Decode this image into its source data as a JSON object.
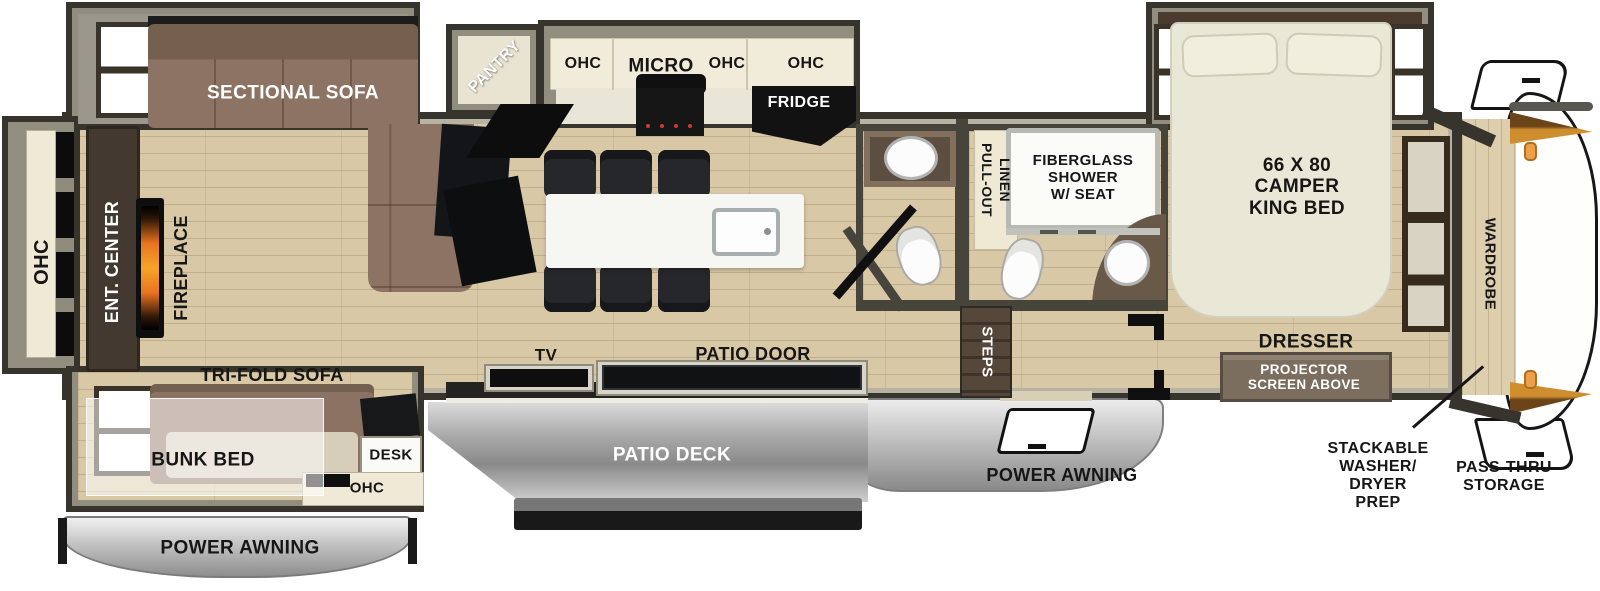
{
  "plan_type": "fifth-wheel-rv-floorplan",
  "colors": {
    "floor_wood": "#d9c8a6",
    "wall_fill": "#918e7f",
    "wall_outline": "#36342c",
    "sofa_brown": "#8c7263",
    "bed_cream": "#e9e7d5",
    "cabinet_cream": "#f1ecda",
    "appliance_black": "#151515",
    "deck_gray": "#9f9f9f",
    "awning_gray": "#c9c9c9",
    "cap_accent_orange": "#cf8e2e",
    "marker_light_orange": "#eda04a",
    "flame_orange": "#f6a429"
  },
  "labels": {
    "rear": {
      "ohc": "OHC",
      "ent_center": "ENT. CENTER",
      "fireplace": "FIREPLACE",
      "sectional_sofa": "SECTIONAL SOFA",
      "tri_fold_sofa": "TRI-FOLD SOFA",
      "bunk_bed": "BUNK BED",
      "desk": "DESK",
      "ohc_bunk": "OHC",
      "power_awning": "POWER AWNING"
    },
    "kitchen": {
      "pantry": "PANTRY",
      "ohc_left": "OHC",
      "micro": "MICRO",
      "ohc_mid": "OHC",
      "ohc_right": "OHC",
      "fridge": "FRIDGE",
      "tv": "TV",
      "patio_door": "PATIO DOOR",
      "patio_deck": "PATIO DECK"
    },
    "bath": {
      "pull_out": "PULL-OUT",
      "linen": "LINEN",
      "shower": "FIBERGLASS\nSHOWER\nW/ SEAT",
      "steps": "STEPS",
      "power_awning": "POWER AWNING"
    },
    "bedroom": {
      "king_bed": "66 X 80\nCAMPER\nKING BED",
      "dresser": "DRESSER",
      "projector_screen": "PROJECTOR\nSCREEN ABOVE",
      "wardrobe": "WARDROBE"
    },
    "front": {
      "washer_dryer_prep": "STACKABLE\nWASHER/\nDRYER\nPREP",
      "pass_thru_storage": "PASS-THRU\nSTORAGE"
    }
  }
}
